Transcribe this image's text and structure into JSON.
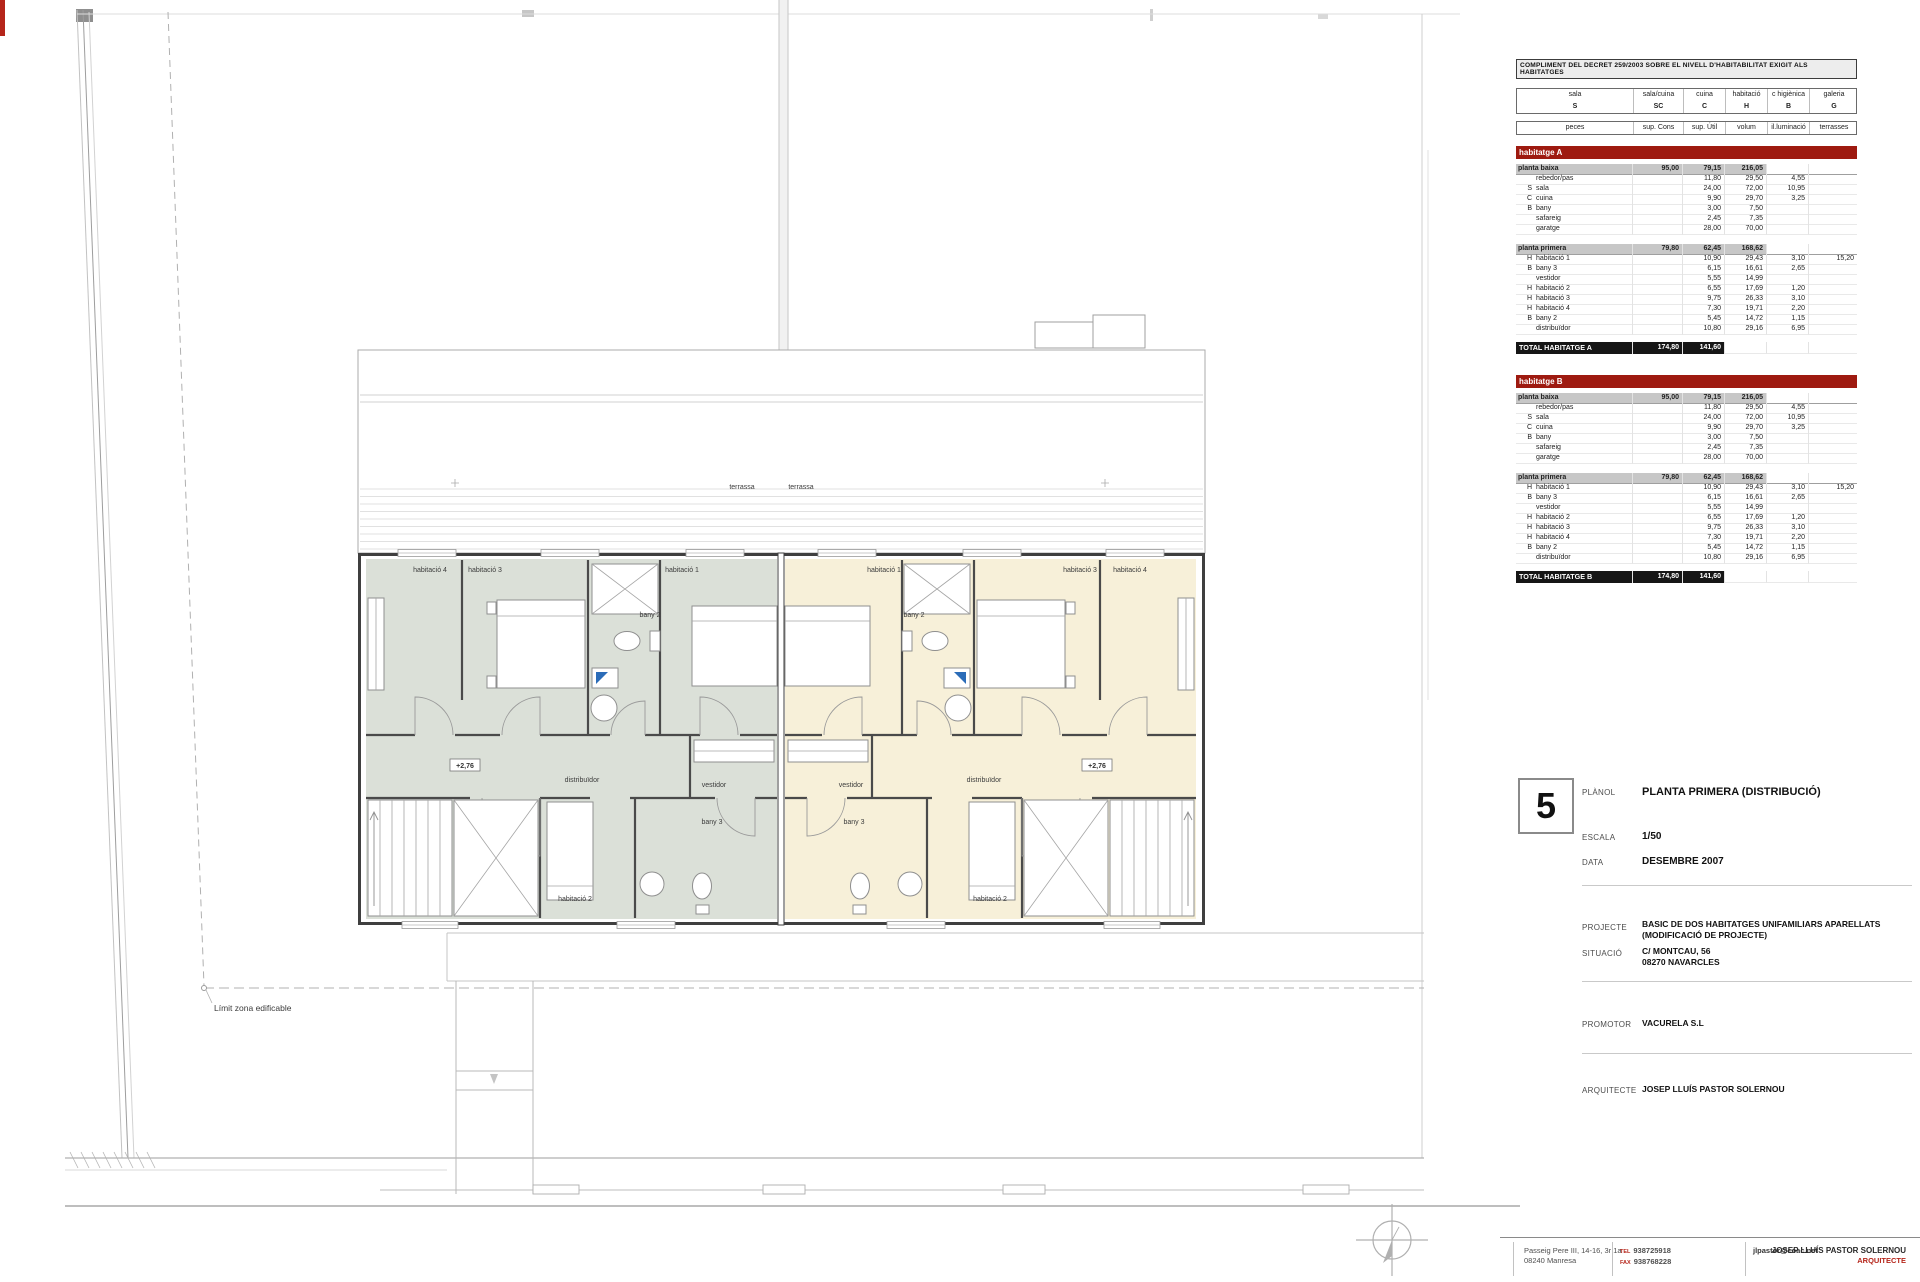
{
  "compliance_table": {
    "title": "COMPLIMENT DEL DECRET 259/2003 SOBRE EL NIVELL D'HABITABILITAT EXIGIT ALS HABITATGES",
    "header_groups": [
      {
        "name": "sala",
        "code": "S"
      },
      {
        "name": "sala/cuina",
        "code": "SC"
      },
      {
        "name": "cuina",
        "code": "C"
      },
      {
        "name": "habitació",
        "code": "H"
      },
      {
        "name": "c higiènica",
        "code": "B"
      },
      {
        "name": "galeria",
        "code": "G"
      }
    ],
    "subheaders": [
      "peces",
      "sup. Cons",
      "sup. Útil",
      "volum",
      "il.luminació",
      "terrasses"
    ],
    "sections": [
      {
        "name": "habitatge A",
        "floors": [
          {
            "name": "planta baixa",
            "cons": "95,00",
            "util": "79,15",
            "volum": "216,05",
            "rooms": [
              {
                "letter": "",
                "name": "rebedor/pas",
                "util": "11,80",
                "volum": "29,50",
                "illum": "4,55",
                "terr": ""
              },
              {
                "letter": "S",
                "name": "sala",
                "util": "24,00",
                "volum": "72,00",
                "illum": "10,95",
                "terr": ""
              },
              {
                "letter": "C",
                "name": "cuina",
                "util": "9,90",
                "volum": "29,70",
                "illum": "3,25",
                "terr": ""
              },
              {
                "letter": "B",
                "name": "bany",
                "util": "3,00",
                "volum": "7,50",
                "illum": "",
                "terr": ""
              },
              {
                "letter": "",
                "name": "safareig",
                "util": "2,45",
                "volum": "7,35",
                "illum": "",
                "terr": ""
              },
              {
                "letter": "",
                "name": "garatge",
                "util": "28,00",
                "volum": "70,00",
                "illum": "",
                "terr": ""
              }
            ]
          },
          {
            "name": "planta primera",
            "cons": "79,80",
            "util": "62,45",
            "volum": "168,62",
            "rooms": [
              {
                "letter": "H",
                "name": "habitació 1",
                "util": "10,90",
                "volum": "29,43",
                "illum": "3,10",
                "terr": "15,20"
              },
              {
                "letter": "B",
                "name": "bany 3",
                "util": "6,15",
                "volum": "16,61",
                "illum": "2,65",
                "terr": ""
              },
              {
                "letter": "",
                "name": "vestidor",
                "util": "5,55",
                "volum": "14,99",
                "illum": "",
                "terr": ""
              },
              {
                "letter": "H",
                "name": "habitació 2",
                "util": "6,55",
                "volum": "17,69",
                "illum": "1,20",
                "terr": ""
              },
              {
                "letter": "H",
                "name": "habitació 3",
                "util": "9,75",
                "volum": "26,33",
                "illum": "3,10",
                "terr": ""
              },
              {
                "letter": "H",
                "name": "habitació 4",
                "util": "7,30",
                "volum": "19,71",
                "illum": "2,20",
                "terr": ""
              },
              {
                "letter": "B",
                "name": "bany 2",
                "util": "5,45",
                "volum": "14,72",
                "illum": "1,15",
                "terr": ""
              },
              {
                "letter": "",
                "name": "distribuïdor",
                "util": "10,80",
                "volum": "29,16",
                "illum": "6,95",
                "terr": ""
              }
            ]
          }
        ],
        "total": {
          "label": "TOTAL HABITATGE A",
          "cons": "174,80",
          "util": "141,60"
        }
      },
      {
        "name": "habitatge B",
        "floors": [
          {
            "name": "planta baixa",
            "cons": "95,00",
            "util": "79,15",
            "volum": "216,05",
            "rooms": [
              {
                "letter": "",
                "name": "rebedor/pas",
                "util": "11,80",
                "volum": "29,50",
                "illum": "4,55",
                "terr": ""
              },
              {
                "letter": "S",
                "name": "sala",
                "util": "24,00",
                "volum": "72,00",
                "illum": "10,95",
                "terr": ""
              },
              {
                "letter": "C",
                "name": "cuina",
                "util": "9,90",
                "volum": "29,70",
                "illum": "3,25",
                "terr": ""
              },
              {
                "letter": "B",
                "name": "bany",
                "util": "3,00",
                "volum": "7,50",
                "illum": "",
                "terr": ""
              },
              {
                "letter": "",
                "name": "safareig",
                "util": "2,45",
                "volum": "7,35",
                "illum": "",
                "terr": ""
              },
              {
                "letter": "",
                "name": "garatge",
                "util": "28,00",
                "volum": "70,00",
                "illum": "",
                "terr": ""
              }
            ]
          },
          {
            "name": "planta primera",
            "cons": "79,80",
            "util": "62,45",
            "volum": "168,62",
            "rooms": [
              {
                "letter": "H",
                "name": "habitació 1",
                "util": "10,90",
                "volum": "29,43",
                "illum": "3,10",
                "terr": "15,20"
              },
              {
                "letter": "B",
                "name": "bany 3",
                "util": "6,15",
                "volum": "16,61",
                "illum": "2,65",
                "terr": ""
              },
              {
                "letter": "",
                "name": "vestidor",
                "util": "5,55",
                "volum": "14,99",
                "illum": "",
                "terr": ""
              },
              {
                "letter": "H",
                "name": "habitació 2",
                "util": "6,55",
                "volum": "17,69",
                "illum": "1,20",
                "terr": ""
              },
              {
                "letter": "H",
                "name": "habitació 3",
                "util": "9,75",
                "volum": "26,33",
                "illum": "3,10",
                "terr": ""
              },
              {
                "letter": "H",
                "name": "habitació 4",
                "util": "7,30",
                "volum": "19,71",
                "illum": "2,20",
                "terr": ""
              },
              {
                "letter": "B",
                "name": "bany 2",
                "util": "5,45",
                "volum": "14,72",
                "illum": "1,15",
                "terr": ""
              },
              {
                "letter": "",
                "name": "distribuïdor",
                "util": "10,80",
                "volum": "29,16",
                "illum": "6,95",
                "terr": ""
              }
            ]
          }
        ],
        "total": {
          "label": "TOTAL HABITATGE B",
          "cons": "174,80",
          "util": "141,60"
        }
      }
    ]
  },
  "title_block": {
    "sheet_number": "5",
    "planol_label": "PLÀNOL",
    "planol": "PLANTA PRIMERA  (DISTRIBUCIÓ)",
    "escala_label": "ESCALA",
    "escala": "1/50",
    "data_label": "DATA",
    "data": "DESEMBRE 2007",
    "projecte_label": "PROJECTE",
    "projecte_line1": "BASIC DE DOS HABITATGES UNIFAMILIARS APARELLATS",
    "projecte_line2": "(MODIFICACIÓ DE PROJECTE)",
    "situacio_label": "SITUACIÓ",
    "situacio_line1": "C/ MONTCAU, 56",
    "situacio_line2": "08270 NAVARCLES",
    "promotor_label": "PROMOTOR",
    "promotor": "VACURELA S.L",
    "arquitecte_label": "ARQUITECTE",
    "arquitecte": "JOSEP LLUÍS PASTOR SOLERNOU"
  },
  "footer": {
    "address_line1": "Passeig Pere III, 14-16, 3r 1a",
    "address_line2": "08240 Manresa",
    "tel_label": "TEL",
    "tel": "938725918",
    "fax_label": "FAX",
    "fax": "938768228",
    "email": "jlpastor@coac.net",
    "name": "JOSEP LLUÍS PASTOR SOLERNOU",
    "role": "ARQUITECTE"
  },
  "plan": {
    "colors": {
      "unit_a_fill": "#dbe0d8",
      "unit_b_fill": "#f7f0d9",
      "banner_red": "#9e1a10"
    },
    "labels": [
      {
        "t": "terrassa",
        "x": 742,
        "y": 489
      },
      {
        "t": "terrassa",
        "x": 801,
        "y": 489
      },
      {
        "t": "habitació 4",
        "x": 430,
        "y": 572
      },
      {
        "t": "habitació 3",
        "x": 485,
        "y": 572
      },
      {
        "t": "bany 2",
        "x": 650,
        "y": 617
      },
      {
        "t": "habitació 1",
        "x": 682,
        "y": 572
      },
      {
        "t": "distribuïdor",
        "x": 582,
        "y": 782
      },
      {
        "t": "vestidor",
        "x": 714,
        "y": 787
      },
      {
        "t": "bany 3",
        "x": 712,
        "y": 824
      },
      {
        "t": "habitació 2",
        "x": 575,
        "y": 901
      },
      {
        "t": "habitació 1",
        "x": 884,
        "y": 572
      },
      {
        "t": "bany 2",
        "x": 914,
        "y": 617
      },
      {
        "t": "habitació 3",
        "x": 1080,
        "y": 572
      },
      {
        "t": "habitació 4",
        "x": 1130,
        "y": 572
      },
      {
        "t": "distribuïdor",
        "x": 984,
        "y": 782
      },
      {
        "t": "vestidor",
        "x": 851,
        "y": 787
      },
      {
        "t": "bany 3",
        "x": 854,
        "y": 824
      },
      {
        "t": "habitació 2",
        "x": 990,
        "y": 901
      },
      {
        "t": "Límit zona edificable",
        "x": 214,
        "y": 1011,
        "a": "start",
        "s": 8.5
      }
    ],
    "markers": [
      {
        "t": "+2,76",
        "x": 465,
        "y": 768
      },
      {
        "t": "+2,76",
        "x": 1097,
        "y": 768
      }
    ]
  }
}
